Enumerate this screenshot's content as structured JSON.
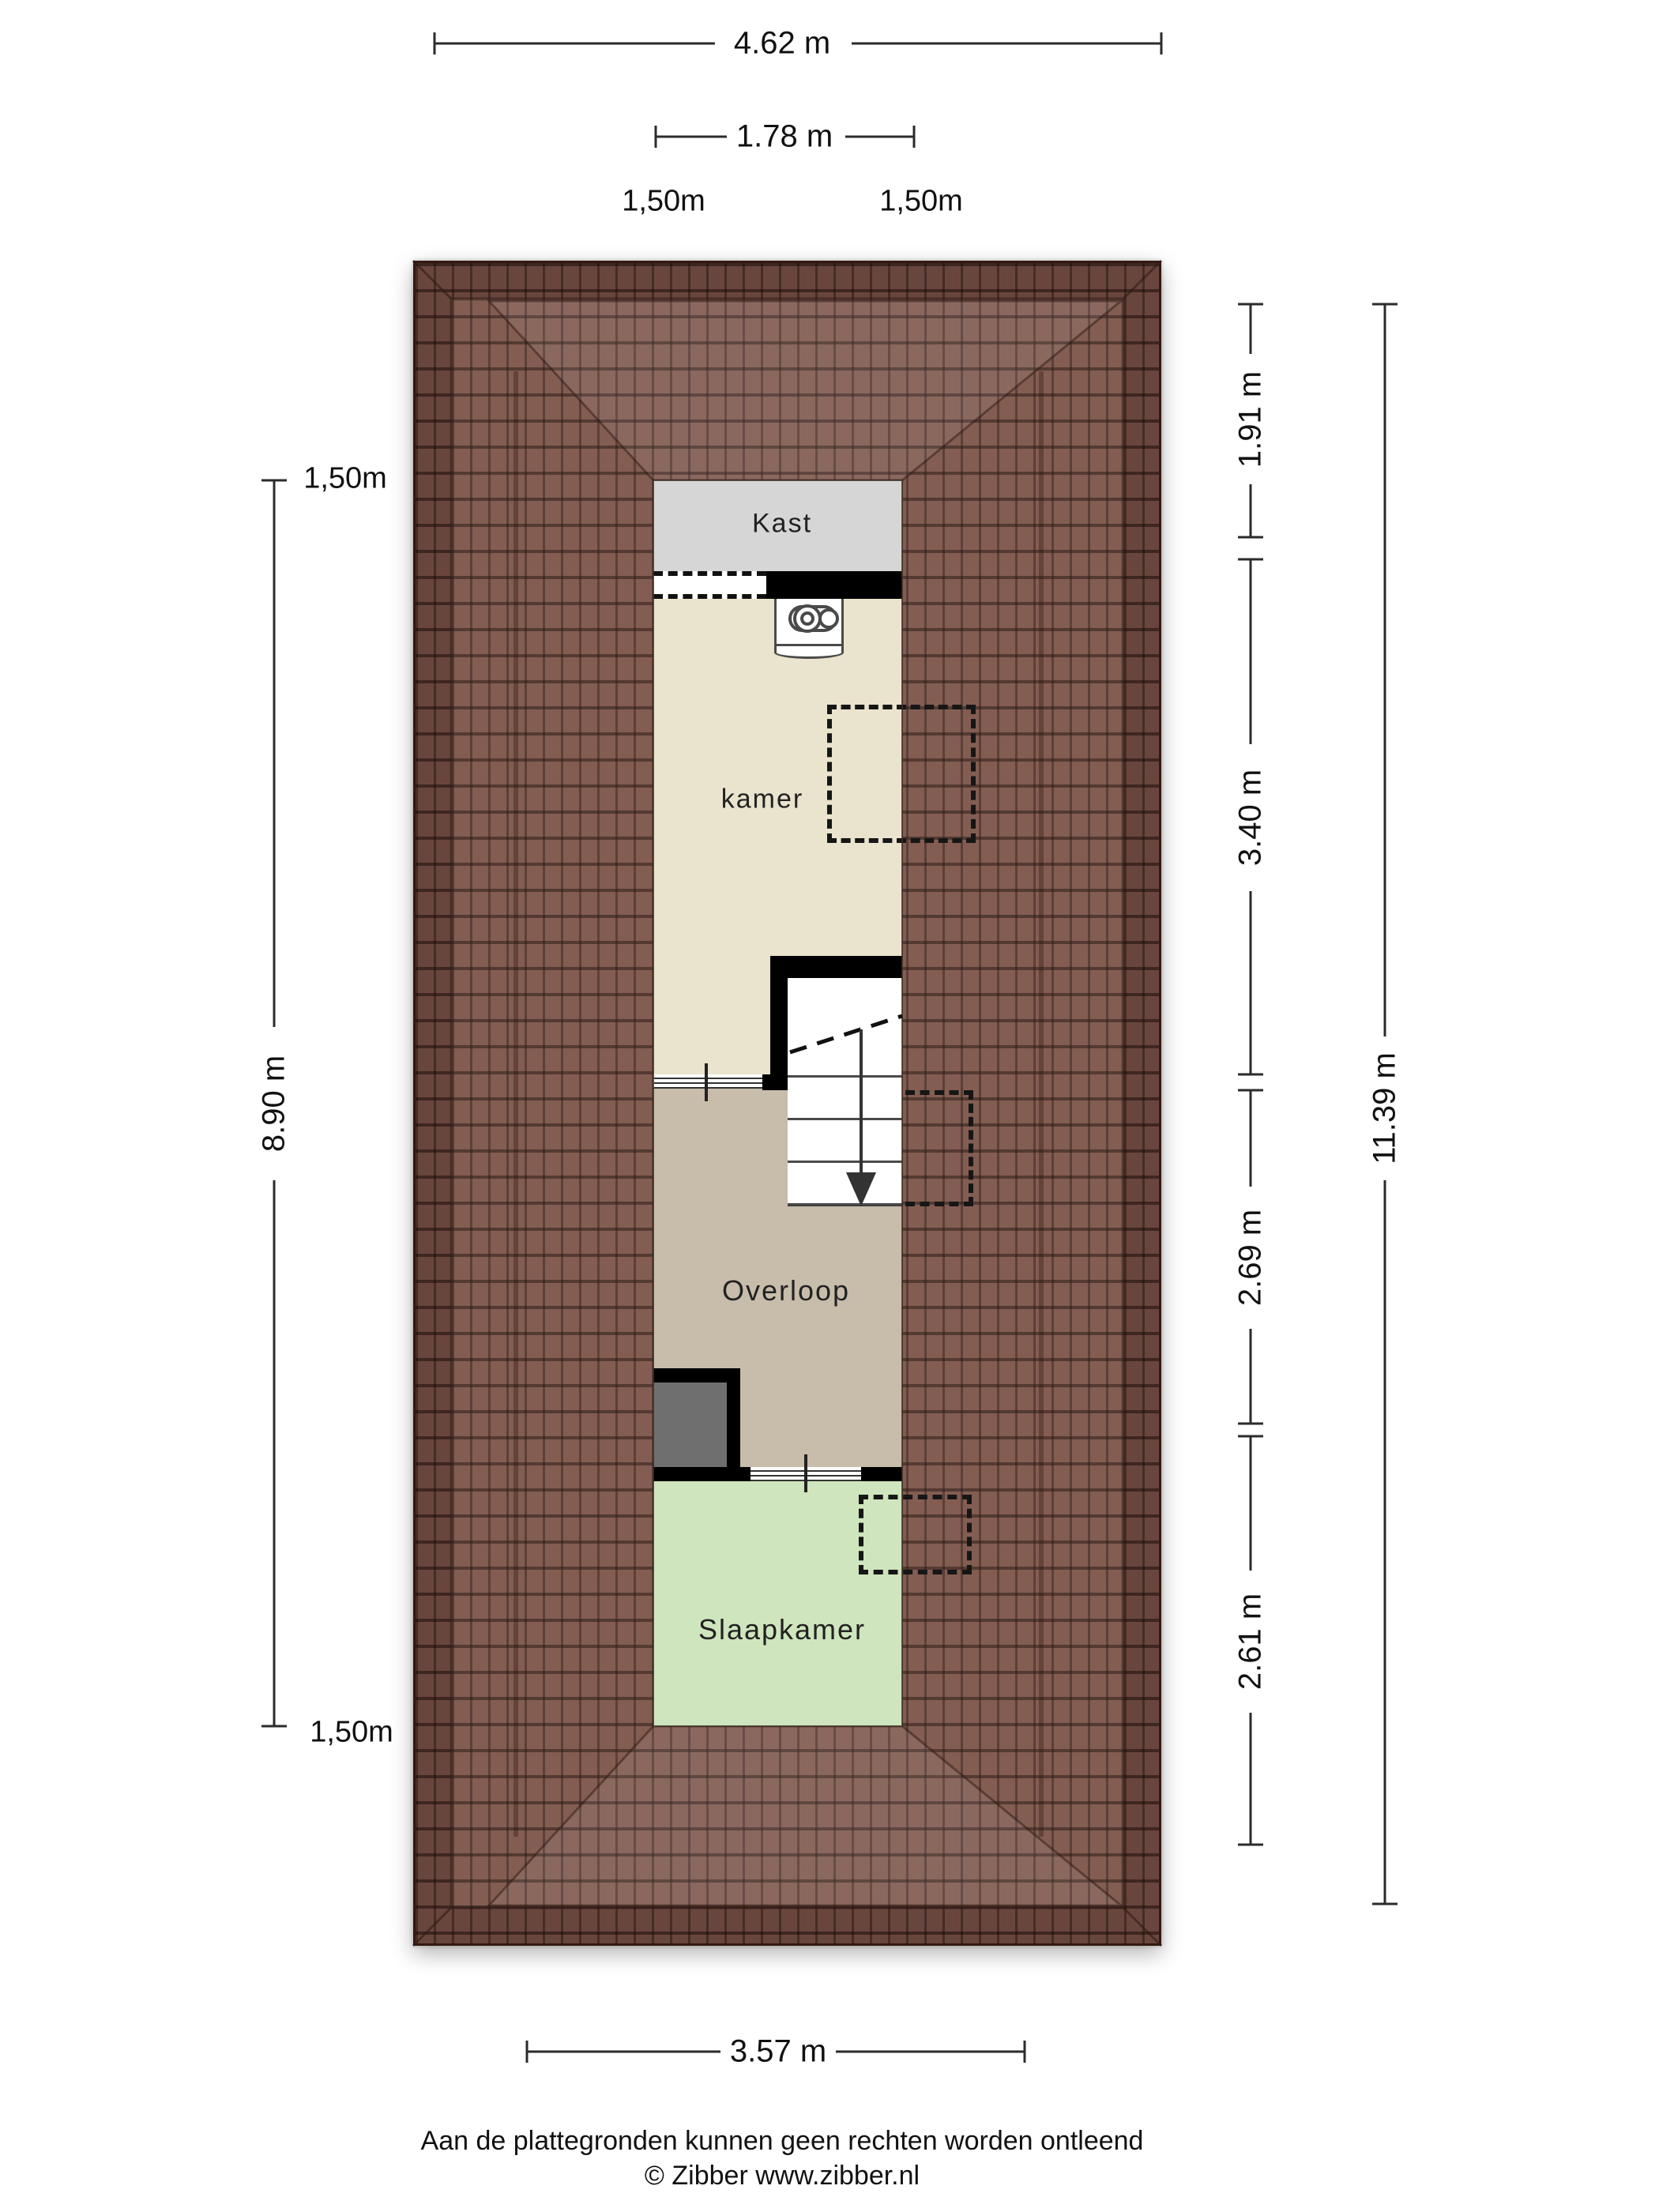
{
  "floorplan": {
    "rooms": [
      {
        "id": "kast",
        "label": "Kast"
      },
      {
        "id": "kamer",
        "label": "kamer"
      },
      {
        "id": "overloop",
        "label": "Overloop"
      },
      {
        "id": "slaapkamer",
        "label": "Slaapkamer"
      }
    ],
    "features": [
      "mechanical-ventilation-unit",
      "staircase-down",
      "roof-window-kamer",
      "roof-window-stairs",
      "roof-window-slaapkamer"
    ],
    "dimensions": {
      "top_total": "4.62 m",
      "top_inner": "1.78 m",
      "contour_top_left": "1,50m",
      "contour_top_right": "1,50m",
      "left_contour_top": "1,50m",
      "left_length": "8.90 m",
      "left_contour_bottom": "1,50m",
      "right_segments": [
        "1.91 m",
        "3.40 m",
        "2.69 m",
        "2.61 m"
      ],
      "right_total": "11.39 m",
      "bottom_width": "3.57 m"
    },
    "footer": {
      "disclaimer": "Aan de plattegronden kunnen geen rechten worden ontleend",
      "credit": "© Zibber www.zibber.nl"
    },
    "colors": {
      "roof_base": "#7c5348",
      "roof_line": "#35190f",
      "kast": "#d6d6d6",
      "kamer": "#eae3cd",
      "overloop": "#c8bcab",
      "slaapkamer": "#cfe5bd",
      "shaft_gray": "#6f6f6f",
      "wall": "#000000"
    }
  }
}
